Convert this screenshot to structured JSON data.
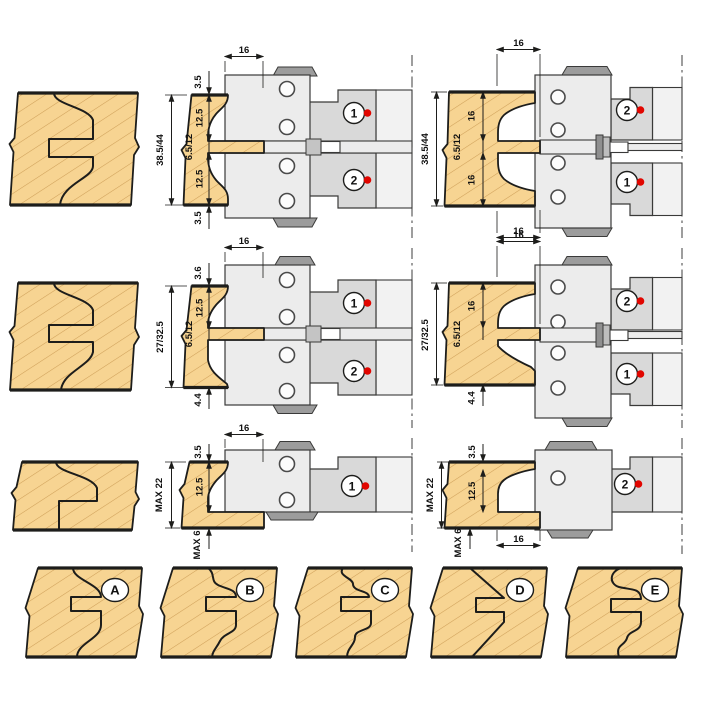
{
  "colors": {
    "wood": "#f7d492",
    "wood_hatch": "#cfa05a",
    "steel_light": "#ececec",
    "steel_mid": "#d9d9d9",
    "steel_dark": "#9c9c9c",
    "outline": "#1d1d1b",
    "red_dot": "#e10600"
  },
  "set1": {
    "middle": {
      "top_width": "16",
      "gap_top": "3.5",
      "seg_upper": "12.5",
      "seg_mid": "6.5/12",
      "seg_lower": "12.5",
      "gap_bottom": "3.5",
      "overall": "38.5/44",
      "upper_cutter": "1",
      "lower_cutter": "2"
    },
    "right": {
      "top_width": "16",
      "seg_upper": "16",
      "seg_mid": "6.5/12",
      "seg_lower": "16",
      "bottom_width": "16",
      "overall": "38.5/44",
      "upper_cutter": "2",
      "lower_cutter": "1"
    }
  },
  "set2": {
    "middle": {
      "top_width": "16",
      "gap_top": "3.6",
      "seg_upper": "12.5",
      "seg_mid": "6.5/12",
      "gap_bottom": "4.4",
      "overall": "27/32.5",
      "upper_cutter": "1",
      "lower_cutter": "2"
    },
    "right": {
      "top_width": "16",
      "seg_upper": "16",
      "seg_mid": "6.5/12",
      "gap_bottom": "4.4",
      "overall": "27/32.5",
      "upper_cutter": "2",
      "lower_cutter": "1"
    }
  },
  "set3": {
    "middle": {
      "top_width": "16",
      "gap_top": "3.5",
      "seg_upper": "12.5",
      "gap_bottom": "MAX 6",
      "overall": "MAX 22",
      "cutter": "1"
    },
    "right": {
      "bottom_width": "16",
      "gap_top": "3.5",
      "seg_upper": "12.5",
      "gap_bottom": "MAX 6",
      "overall": "MAX 22",
      "cutter": "2"
    }
  },
  "profiles": [
    {
      "label": "A"
    },
    {
      "label": "B"
    },
    {
      "label": "C"
    },
    {
      "label": "D"
    },
    {
      "label": "E"
    }
  ]
}
